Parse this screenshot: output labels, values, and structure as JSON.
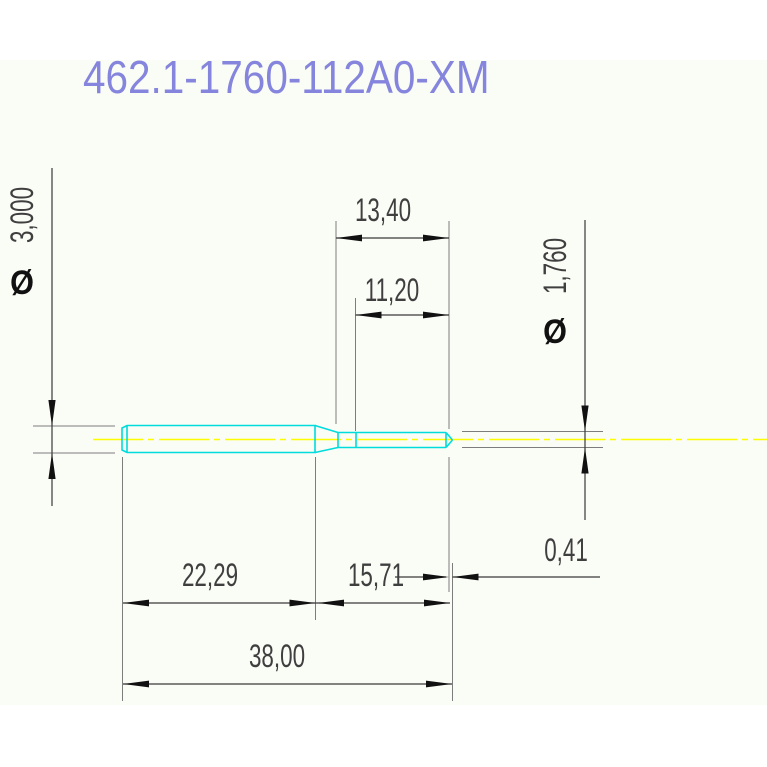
{
  "title": "462.1-1760-112A0-XM",
  "labels": {
    "dim_top_outer": "13,40",
    "dim_top_inner": "11,20",
    "dia_left_symbol": "Ø",
    "dia_left_value": "3,000",
    "dia_right_symbol": "Ø",
    "dia_right_value": "1,760",
    "dim_bottom_left": "22,29",
    "dim_bottom_mid": "15,71",
    "dim_tip_offset": "0,41",
    "dim_total_length": "38,00"
  },
  "colors": {
    "sheet_bg": "#fafcf6",
    "part_outline": "#00dcdc",
    "centerline": "#fdfd00",
    "extension_line": "#7d7d7d",
    "dimension_line": "#3a3a3a",
    "arrow": "#111111",
    "dimension_text": "#3f3f3f",
    "title": "#8585dd"
  }
}
